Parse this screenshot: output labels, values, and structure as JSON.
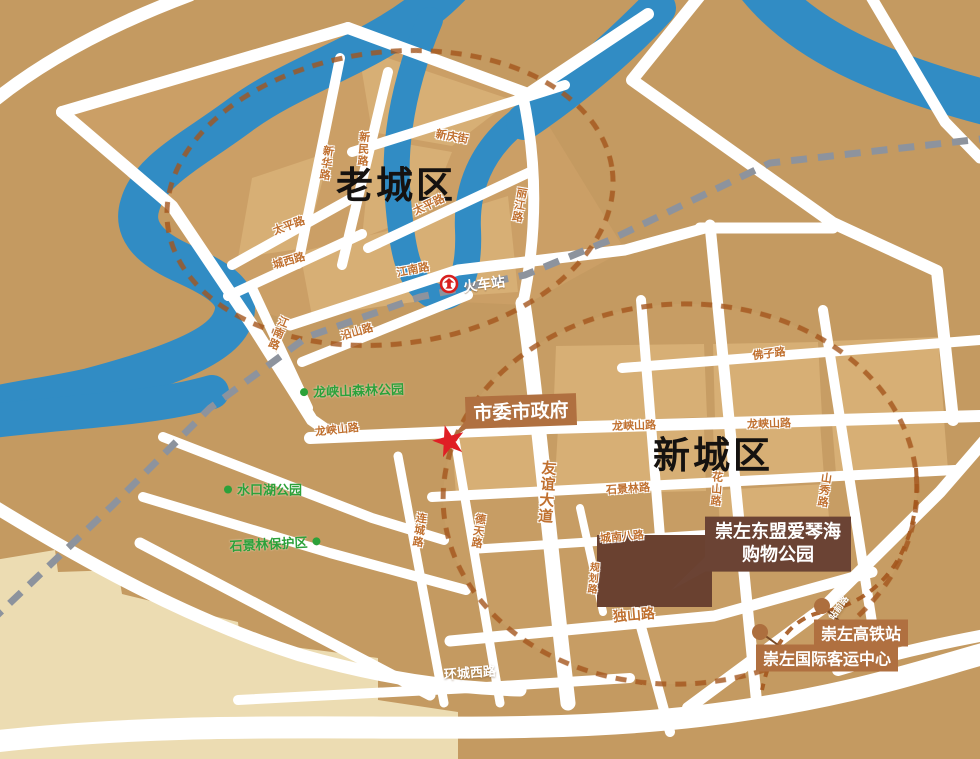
{
  "map": {
    "districts": [
      {
        "text": "老城区"
      },
      {
        "text": "新城区"
      }
    ],
    "roads": [
      "新华路",
      "新民路",
      "新庆街",
      "太平路",
      "太平路",
      "城西路",
      "丽江路",
      "江南路",
      "江南路",
      "沿山路",
      "龙峡山路",
      "龙峡山路",
      "龙峡山路",
      "佛子路",
      "友谊大道",
      "德天路",
      "连城路",
      "石景林路",
      "花山路",
      "山秀路",
      "城南八路",
      "规划路",
      "独山路",
      "环城西路",
      "站前路"
    ],
    "parks": [
      {
        "text": "龙峡山森林公园"
      },
      {
        "text": "水口湖公园"
      },
      {
        "text": "石景林保护区"
      }
    ],
    "pois": {
      "government": "市委市政府",
      "train_station": "火车站",
      "shopping_park_line1": "崇左东盟爱琴海",
      "shopping_park_line2": "购物公园",
      "hsr_station": "崇左高铁站",
      "bus_center": "崇左国际客运中心"
    },
    "colors": {
      "land": "#c49a61",
      "block_light": "#d7af75",
      "district_zone": "#cb9f66",
      "water": "#318cc4",
      "road": "#ffffff",
      "railway": "#8d939d",
      "boundary_dash": "#a4561d",
      "road_label": "#c0702f",
      "park_label": "#2ca13a",
      "badge_brown": "#b07040",
      "badge_dark": "#6b4334",
      "building_dark": "#6a4130",
      "star_red": "#e01f25",
      "terrain_beige": "#ecdcb2"
    }
  }
}
